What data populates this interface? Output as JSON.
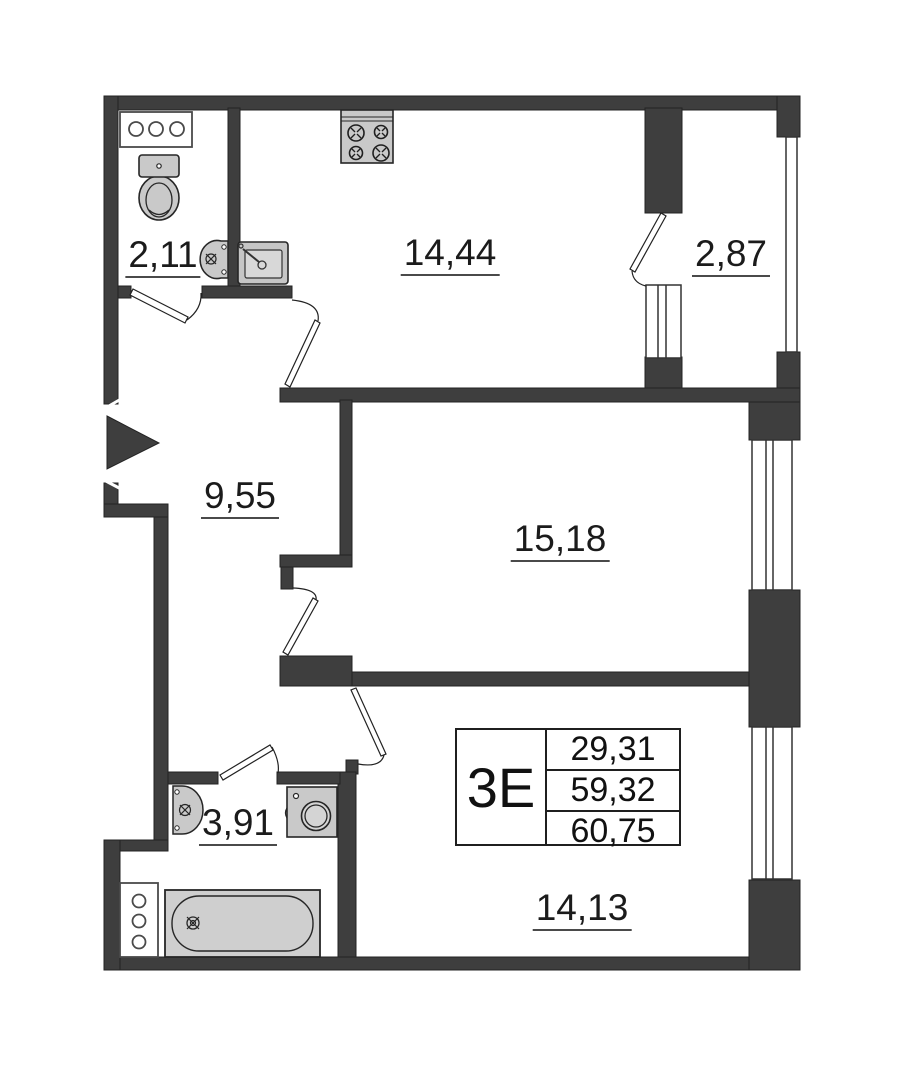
{
  "page": {
    "background": "#ffffff"
  },
  "plan": {
    "name": "apartment-floor-plan",
    "colors": {
      "wall": "#3e3e3e",
      "wall_outline": "#232323",
      "fixture_fill": "#c9c9c9",
      "fixture_fill_light": "#d8d8d8",
      "window_line": "#333333",
      "text": "#1b1b1b"
    },
    "rooms": [
      {
        "id": "wc",
        "label": "2,11"
      },
      {
        "id": "kitchen",
        "label": "14,44"
      },
      {
        "id": "balcony",
        "label": "2,87"
      },
      {
        "id": "hallway",
        "label": "9,55"
      },
      {
        "id": "living-room-1",
        "label": "15,18"
      },
      {
        "id": "bathroom",
        "label": "3,91"
      },
      {
        "id": "living-room-2",
        "label": "14,13"
      }
    ],
    "unit_info": {
      "type_label": "3Е",
      "areas": [
        {
          "value": "29,31"
        },
        {
          "value": "59,32"
        },
        {
          "value": "60,75"
        }
      ]
    }
  }
}
